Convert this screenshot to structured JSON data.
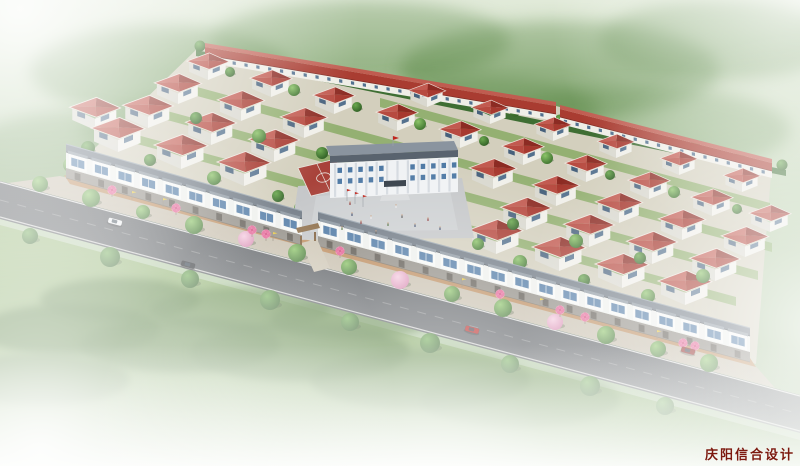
{
  "watermark": {
    "text": "庆阳信合设计",
    "color": "#7c190e"
  },
  "scene": {
    "size": {
      "w": 800,
      "h": 466
    },
    "palette": {
      "sky": [
        "#d8e4cd",
        "#b5cca7",
        "#9cb98d"
      ],
      "meadow_top": "#94b573",
      "meadow_bottom": "#6f9a51",
      "road": "#54585c",
      "road_edge_line": "#e9e9e7",
      "ground": "#d3cfbd",
      "ground_stripe": "#7fa65a",
      "sidewalk": "#c6bdab",
      "brick_walk": "#b8824f",
      "house_roof": [
        "#a7392f",
        "#8c2b23",
        "#c25a50",
        "#b74a40"
      ],
      "house_wall_light": "#f0efe9",
      "house_wall_shade": "#d9d8cf",
      "window_glass": "#4d78a4",
      "window_dark": "#46607c",
      "strip_roof": "#6e7883",
      "strip_roof_ridge": "#98a4ae",
      "strip_facade": "#eef0ed",
      "strip_bay": "#f7f8f6",
      "strip_cap": "#8b96a0",
      "strip_front": "#8e8a82",
      "door": "#59544c",
      "terrace_roof": "#a93c31",
      "terrace_roof_top": "#c05c50",
      "terrace_wall": "#efeee7",
      "school_roof_top": "#8a949f",
      "school_roof": "#59636e",
      "school_wall": "#f0f2f4",
      "school_column": "#d5dae0",
      "school_canopy": "#333c46",
      "school_steps": "#d8dadc",
      "court": "#a8423a",
      "court_line": "#e8e4de",
      "plaza": "#c4c6c8",
      "plaza_inner": "#ced0d2",
      "hedge": "#3e6e33",
      "umbrella_canopy": "#f6eef2",
      "umbrella_petal": "#e45e92",
      "umbrella_center": "#c23568",
      "flag_yellow": "#e6c433",
      "pole": "#8a8070",
      "gate_wood": "#8a6a44",
      "gate_post": "#7b5a36",
      "driveway": "#ccc4b2",
      "school_flag_red": "#c0271d"
    },
    "road": {
      "surface": [
        [
          0,
          181
        ],
        [
          800,
          395
        ],
        [
          800,
          433
        ],
        [
          0,
          219
        ]
      ],
      "edge_top": [
        [
          0,
          182
        ],
        [
          800,
          396
        ]
      ],
      "edge_bottom": [
        [
          0,
          217
        ],
        [
          800,
          431
        ]
      ],
      "center_dash": [
        [
          0,
          200
        ],
        [
          800,
          414
        ]
      ]
    },
    "pavement": {
      "sidewalk": [
        [
          60,
          176
        ],
        [
          752,
          362
        ],
        [
          775,
          388
        ],
        [
          8,
          183
        ]
      ],
      "brick": [
        [
          64,
          175
        ],
        [
          750,
          358
        ],
        [
          756,
          367
        ],
        [
          70,
          184
        ]
      ]
    },
    "site_ground": [
      [
        200,
        46
      ],
      [
        556,
        106
      ],
      [
        772,
        162
      ],
      [
        756,
        364
      ],
      [
        64,
        178
      ]
    ],
    "ground_stripes": [
      [
        [
          96,
          156
        ],
        [
          706,
          321
        ],
        [
          706,
          330
        ],
        [
          96,
          165
        ]
      ],
      [
        [
          126,
          132
        ],
        [
          736,
          297
        ],
        [
          736,
          306
        ],
        [
          126,
          141
        ]
      ],
      [
        [
          156,
          108
        ],
        [
          758,
          271
        ],
        [
          758,
          280
        ],
        [
          156,
          117
        ]
      ],
      [
        [
          186,
          84
        ],
        [
          772,
          243
        ],
        [
          772,
          252
        ],
        [
          186,
          93
        ]
      ],
      [
        [
          380,
          98
        ],
        [
          770,
          203
        ],
        [
          770,
          212
        ],
        [
          380,
          107
        ]
      ]
    ],
    "hedge_band": [
      [
        196,
        50
      ],
      [
        786,
        170
      ],
      [
        786,
        176
      ],
      [
        196,
        56
      ]
    ],
    "meadow": [
      [
        0,
        225
      ],
      [
        800,
        440
      ],
      [
        800,
        466
      ],
      [
        0,
        466
      ]
    ],
    "terraces": [
      {
        "a": [
          205,
          62
        ],
        "b": [
          556,
          121
        ]
      },
      {
        "a": [
          560,
          124
        ],
        "b": [
          772,
          178
        ]
      }
    ],
    "strips": [
      {
        "a": [
          66,
          178
        ],
        "b": [
          302,
          245
        ],
        "units": 10
      },
      {
        "a": [
          318,
          246
        ],
        "b": [
          750,
          362
        ],
        "units": 18
      }
    ],
    "houses": [
      [
        118,
        152,
        1.5
      ],
      [
        181,
        169,
        1.5
      ],
      [
        244,
        186,
        1.5
      ],
      [
        496,
        254,
        1.5
      ],
      [
        559,
        271,
        1.5
      ],
      [
        622,
        288,
        1.5
      ],
      [
        685,
        305,
        1.5
      ],
      [
        95,
        130,
        1.42
      ],
      [
        148,
        128,
        1.42
      ],
      [
        211,
        145,
        1.42
      ],
      [
        274,
        162,
        1.42
      ],
      [
        526,
        230,
        1.42
      ],
      [
        589,
        247,
        1.42
      ],
      [
        652,
        264,
        1.42
      ],
      [
        715,
        281,
        1.42
      ],
      [
        178,
        104,
        1.32
      ],
      [
        241,
        121,
        1.32
      ],
      [
        304,
        138,
        1.32
      ],
      [
        493,
        189,
        1.32
      ],
      [
        556,
        206,
        1.32
      ],
      [
        619,
        223,
        1.32
      ],
      [
        682,
        240,
        1.32
      ],
      [
        745,
        257,
        1.32
      ],
      [
        208,
        80,
        1.18
      ],
      [
        271,
        97,
        1.18
      ],
      [
        334,
        114,
        1.18
      ],
      [
        397,
        131,
        1.18
      ],
      [
        460,
        148,
        1.18
      ],
      [
        523,
        165,
        1.18
      ],
      [
        586,
        182,
        1.18
      ],
      [
        649,
        199,
        1.18
      ],
      [
        712,
        216,
        1.18
      ],
      [
        770,
        232,
        1.18
      ],
      [
        427,
        107,
        1.04
      ],
      [
        490,
        124,
        1.04
      ],
      [
        553,
        141,
        1.04
      ],
      [
        616,
        158,
        1.04
      ],
      [
        679,
        175,
        1.04
      ],
      [
        742,
        192,
        1.04
      ]
    ],
    "school": {
      "roof_top": [
        [
          326,
          146
        ],
        [
          454,
          141
        ],
        [
          458,
          150
        ],
        [
          330,
          156
        ]
      ],
      "roof_front": [
        [
          330,
          156
        ],
        [
          458,
          150
        ],
        [
          458,
          157
        ],
        [
          330,
          163
        ]
      ],
      "facade": [
        [
          330,
          163
        ],
        [
          458,
          157
        ],
        [
          458,
          192
        ],
        [
          330,
          198
        ]
      ],
      "canopy": [
        [
          384,
          181
        ],
        [
          406,
          180
        ],
        [
          406,
          186
        ],
        [
          384,
          187
        ]
      ],
      "steps": [
        [
          382,
          195
        ],
        [
          408,
          194
        ],
        [
          410,
          200
        ],
        [
          380,
          201
        ]
      ],
      "columns": 12,
      "flag_x": 393,
      "flag_y": 146
    },
    "court": {
      "outline": [
        [
          298,
          168
        ],
        [
          336,
          159
        ],
        [
          349,
          187
        ],
        [
          311,
          196
        ]
      ],
      "center": [
        323.5,
        177.5
      ]
    },
    "plaza": [
      [
        290,
        240
      ],
      [
        298,
        186
      ],
      [
        462,
        178
      ],
      [
        474,
        238
      ]
    ],
    "plaza_inner": [
      [
        310,
        232
      ],
      [
        316,
        196
      ],
      [
        450,
        190
      ],
      [
        458,
        230
      ]
    ],
    "gate": {
      "canopy": [
        [
          296,
          228
        ],
        [
          318,
          223
        ],
        [
          320,
          228
        ],
        [
          298,
          233
        ]
      ],
      "posts": [
        [
          300,
          236
        ],
        [
          314,
          232
        ]
      ],
      "driveway": [
        [
          301,
          243
        ],
        [
          317,
          239
        ],
        [
          330,
          268
        ],
        [
          314,
          272
        ]
      ]
    },
    "flagpoles_plaza": [
      [
        347,
        201
      ],
      [
        355,
        204
      ],
      [
        363,
        207
      ]
    ],
    "site_trees": [
      [
        150,
        160,
        6
      ],
      [
        214,
        178,
        7
      ],
      [
        278,
        196,
        6
      ],
      [
        520,
        262,
        7
      ],
      [
        584,
        280,
        6
      ],
      [
        648,
        296,
        7
      ],
      [
        196,
        118,
        6
      ],
      [
        259,
        136,
        7
      ],
      [
        322,
        153,
        6
      ],
      [
        450,
        206,
        7
      ],
      [
        513,
        224,
        6
      ],
      [
        576,
        241,
        7
      ],
      [
        640,
        258,
        6
      ],
      [
        703,
        276,
        7
      ],
      [
        230,
        72,
        5
      ],
      [
        294,
        90,
        6
      ],
      [
        357,
        107,
        5
      ],
      [
        420,
        124,
        6
      ],
      [
        484,
        141,
        5
      ],
      [
        547,
        158,
        6
      ],
      [
        610,
        175,
        5
      ],
      [
        674,
        192,
        6
      ],
      [
        737,
        209,
        5
      ],
      [
        300,
        208,
        6
      ],
      [
        326,
        206,
        6
      ],
      [
        452,
        200,
        6
      ],
      [
        466,
        232,
        6
      ],
      [
        478,
        244,
        6
      ],
      [
        88,
        148,
        7
      ],
      [
        70,
        165,
        7
      ]
    ],
    "hedge_trees": [
      [
        200,
        46
      ],
      [
        245,
        55
      ],
      [
        290,
        64
      ],
      [
        335,
        74
      ],
      [
        380,
        83
      ],
      [
        425,
        92
      ],
      [
        470,
        101
      ],
      [
        515,
        111
      ],
      [
        560,
        120
      ],
      [
        605,
        129
      ],
      [
        650,
        138
      ],
      [
        695,
        147
      ],
      [
        740,
        157
      ],
      [
        782,
        165
      ]
    ],
    "street_trees": [
      [
        40,
        184,
        8,
        "g"
      ],
      [
        91,
        198,
        9,
        "g"
      ],
      [
        143,
        212,
        7,
        "g"
      ],
      [
        194,
        225,
        9,
        "g"
      ],
      [
        246,
        239,
        8,
        "p"
      ],
      [
        297,
        253,
        9,
        "g"
      ],
      [
        349,
        267,
        8,
        "g"
      ],
      [
        400,
        280,
        9,
        "p"
      ],
      [
        452,
        294,
        8,
        "g"
      ],
      [
        503,
        308,
        9,
        "g"
      ],
      [
        555,
        322,
        8,
        "p"
      ],
      [
        606,
        335,
        9,
        "g"
      ],
      [
        658,
        349,
        8,
        "g"
      ],
      [
        709,
        363,
        9,
        "g"
      ]
    ],
    "verge_trees": [
      [
        30,
        236,
        8
      ],
      [
        110,
        257,
        10
      ],
      [
        190,
        279,
        9
      ],
      [
        270,
        300,
        10
      ],
      [
        350,
        322,
        9
      ],
      [
        430,
        343,
        10
      ],
      [
        510,
        364,
        9
      ],
      [
        590,
        386,
        10
      ],
      [
        665,
        406,
        9
      ]
    ],
    "umbrellas": [
      [
        112,
        197
      ],
      [
        176,
        215
      ],
      [
        252,
        237
      ],
      [
        266,
        241
      ],
      [
        340,
        258
      ],
      [
        500,
        301
      ],
      [
        560,
        317
      ],
      [
        585,
        324
      ],
      [
        683,
        350
      ],
      [
        695,
        353
      ]
    ],
    "flags": [
      [
        132,
        200
      ],
      [
        163,
        207
      ],
      [
        273,
        241
      ],
      [
        462,
        287
      ],
      [
        540,
        307
      ],
      [
        657,
        339
      ]
    ],
    "cars": [
      {
        "x": 115,
        "y": 222,
        "color": "#eef0f2"
      },
      {
        "x": 188,
        "y": 265,
        "color": "#23262a"
      },
      {
        "x": 472,
        "y": 330,
        "color": "#b41f1c"
      },
      {
        "x": 688,
        "y": 351,
        "color": "#8e1f1c"
      }
    ],
    "people": [
      [
        352,
        216
      ],
      [
        361,
        224
      ],
      [
        371,
        219
      ],
      [
        388,
        226
      ],
      [
        402,
        218
      ],
      [
        415,
        227
      ],
      [
        428,
        221
      ],
      [
        396,
        208
      ],
      [
        342,
        230
      ],
      [
        376,
        234
      ],
      [
        440,
        230
      ],
      [
        350,
        205
      ]
    ],
    "hill_blobs": [
      [
        160,
        70,
        130,
        45,
        0.55
      ],
      [
        360,
        40,
        150,
        40,
        0.5
      ],
      [
        560,
        70,
        160,
        50,
        0.5
      ],
      [
        720,
        40,
        120,
        40,
        0.45
      ],
      [
        260,
        130,
        180,
        40,
        0.45
      ],
      [
        640,
        130,
        150,
        45,
        0.4
      ],
      [
        80,
        160,
        120,
        50,
        0.5
      ],
      [
        460,
        110,
        140,
        35,
        0.4
      ]
    ],
    "meadow_blobs": [
      [
        70,
        330,
        90,
        26,
        0.8
      ],
      [
        180,
        345,
        100,
        28,
        0.75
      ],
      [
        300,
        352,
        110,
        30,
        0.7
      ],
      [
        420,
        380,
        110,
        30,
        0.6
      ],
      [
        120,
        300,
        80,
        22,
        0.7
      ],
      [
        240,
        310,
        90,
        22,
        0.6
      ],
      [
        40,
        380,
        90,
        26,
        0.7
      ],
      [
        520,
        400,
        100,
        28,
        0.5
      ],
      [
        350,
        320,
        80,
        20,
        0.6
      ]
    ]
  }
}
